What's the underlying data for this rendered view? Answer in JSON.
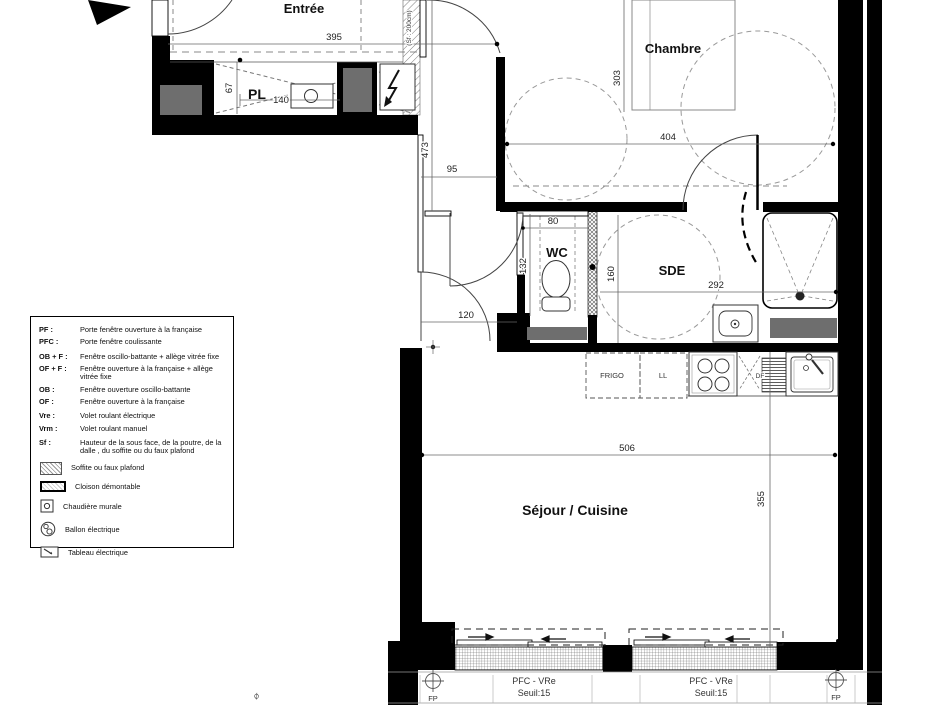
{
  "plan": {
    "rooms": {
      "entree": "Entrée",
      "chambre": "Chambre",
      "pl": "PL",
      "wc": "WC",
      "sde": "SDE",
      "sejour": "Séjour / Cuisine"
    },
    "dims": {
      "entree_w": "395",
      "pl_d": "67",
      "pl_w": "140",
      "hall_l": "473",
      "hall_w": "95",
      "chambre_d": "303",
      "chambre_w": "404",
      "wc_w": "80",
      "wc_d": "132",
      "sde_d": "160",
      "sde_w": "292",
      "door_w": "120",
      "sejour_w": "506",
      "sejour_d": "355"
    },
    "notes": {
      "sf": "(Sf : 200cm)",
      "edge": "Ø"
    },
    "kitchen": {
      "fridge": "FRIGO",
      "washer": "LL",
      "dw": "DF"
    },
    "openings": {
      "w1_label": "PFC - VRe",
      "w1_sill": "Seuil:15",
      "w2_label": "PFC - VRe",
      "w2_sill": "Seuil:15",
      "fp_left": "FP",
      "fp_right": "FP"
    }
  },
  "legend": {
    "items": [
      {
        "abbr": "PF :",
        "desc": "Porte fenêtre ouverture à la française"
      },
      {
        "abbr": "PFC :",
        "desc": "Porte fenêtre coulissante"
      },
      {
        "abbr": "OB + F :",
        "desc": "Fenêtre oscillo-battante + allège vitrée fixe"
      },
      {
        "abbr": "OF + F :",
        "desc": "Fenêtre ouverture à la française + allège vitrée fixe"
      },
      {
        "abbr": "OB :",
        "desc": "Fenêtre ouverture oscillo-battante"
      },
      {
        "abbr": "OF :",
        "desc": "Fenêtre ouverture à la française"
      },
      {
        "abbr": "Vre :",
        "desc": "Volet roulant électrique"
      },
      {
        "abbr": "Vrm :",
        "desc": "Volet roulant manuel"
      },
      {
        "abbr": "Sf :",
        "desc": "Hauteur de la sous face, de la poutre, de la dalle , du soffite ou du faux plafond"
      }
    ],
    "symbols": [
      {
        "label": "Soffite ou faux plafond"
      },
      {
        "label": "Cloison démontable"
      },
      {
        "label": "Chaudière murale"
      },
      {
        "label": "Ballon électrique"
      },
      {
        "label": "Tableau électrique"
      }
    ]
  }
}
